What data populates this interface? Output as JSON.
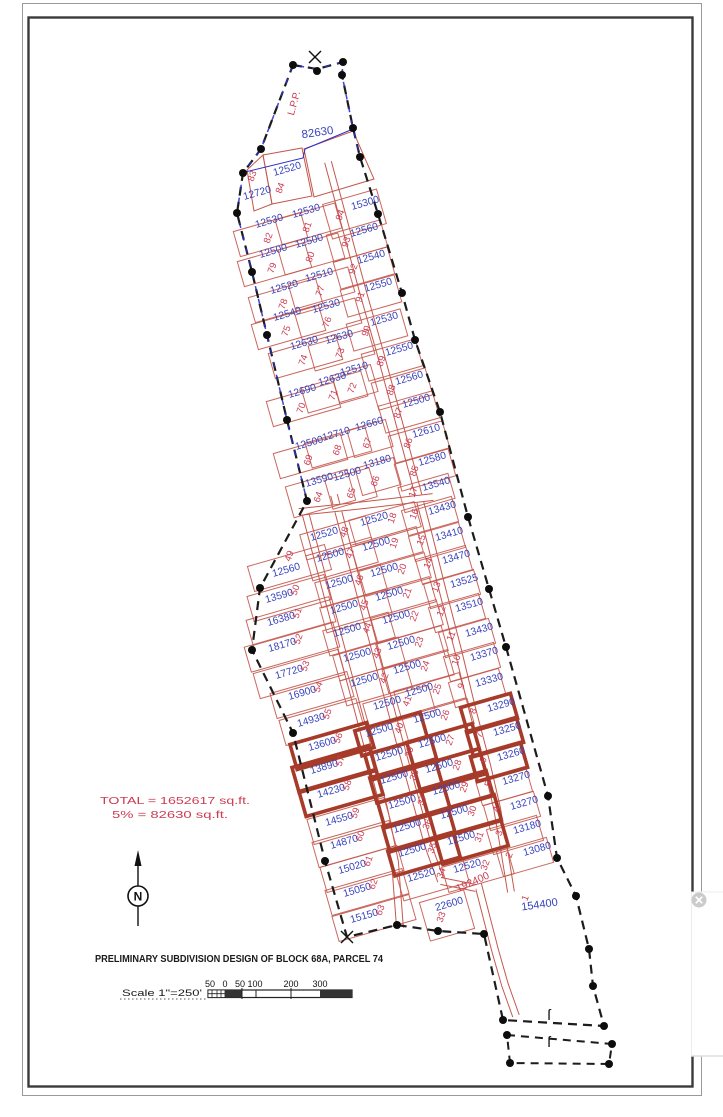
{
  "doc": {
    "title": "PRELIMINARY SUBDIVISION DESIGN OF BLOCK 68A, PARCEL 74",
    "scale_label": "Scale 1\"=250'",
    "scale_ticks": [
      "50",
      "0",
      "50",
      "100",
      "200",
      "300"
    ],
    "total_line1": "TOTAL = 1652617 sq.ft.",
    "total_line2": "5% = 82630 sq.ft.",
    "north_label": "N",
    "lpp_label": "L.P.P.",
    "lpp_area": "82630",
    "road_area": "192400"
  },
  "colors": {
    "lot_line": "#c4574d",
    "lot_thick": "#a63b2a",
    "area_text": "#3743bd",
    "lot_num": "#cc3b52",
    "boundary": "#1c1c1c",
    "blue_edge": "#2b2fc9",
    "annotation_red": "#cc3b52",
    "title_black": "#1a1a1a"
  },
  "plat": {
    "columns": {
      "wT": {
        "w": 0,
        "h": 20,
        "no": [
          -2,
          17
        ]
      },
      "wU": {
        "w": 70,
        "h": 26,
        "no": [
          1,
          15
        ]
      },
      "mU": {
        "w": 62,
        "h": 26,
        "no": [
          3,
          14
        ]
      },
      "m2": {
        "w": 40,
        "h": 28,
        "no": [
          0,
          17
        ]
      },
      "eU": {
        "w": 56,
        "h": 28,
        "no": [
          -16,
          10
        ]
      },
      "wL": {
        "w": 80,
        "h": 26,
        "no": [
          18,
          -8
        ]
      },
      "mwL": {
        "w": 68,
        "h": 26,
        "no": [
          22,
          -4
        ]
      },
      "meL": {
        "w": 68,
        "h": 26,
        "no": [
          20,
          -3
        ]
      },
      "eL": {
        "w": 52,
        "h": 26,
        "no": [
          -26,
          4
        ]
      }
    },
    "overrides": {
      "84": {
        "w": 0,
        "no": [
          -5,
          17
        ]
      },
      "83": {
        "w": 0,
        "no": [
          -3,
          -19
        ]
      },
      "94": {
        "h": 36,
        "no": [
          -23,
          10
        ]
      },
      "64": {
        "w": 64,
        "h": 32
      },
      "65": {
        "w": 46,
        "h": 30,
        "no": [
          6,
          17
        ]
      },
      "49": {
        "no": [
          5,
          -16
        ]
      },
      "51": {
        "w": 86
      },
      "52": {
        "w": 92
      },
      "53": {
        "w": 88
      },
      "54": {
        "w": 80
      },
      "17": {
        "no": [
          -21,
          6
        ]
      },
      "33": {
        "w": 46,
        "h": 40,
        "no": [
          -6,
          11
        ]
      },
      "1": {
        "w": 0,
        "no": [
          -12,
          -9
        ],
        "fs": 11,
        "rot": -8
      }
    },
    "lots": [
      [
        "84",
        "12520",
        288,
        172,
        "wT",
        0
      ],
      [
        "83",
        "12720",
        258,
        196,
        "wT",
        0
      ],
      [
        "94",
        "15300",
        366,
        206,
        "eU",
        0
      ],
      [
        "81",
        "12530",
        307,
        214,
        "mU",
        0
      ],
      [
        "82",
        "12530",
        270,
        224,
        "wU",
        0
      ],
      [
        "93",
        "12560",
        365,
        233,
        "eU",
        0
      ],
      [
        "80",
        "12500",
        310,
        244,
        "mU",
        0
      ],
      [
        "79",
        "12500",
        274,
        254,
        "wU",
        0
      ],
      [
        "92",
        "12540",
        372,
        260,
        "eU",
        0
      ],
      [
        "77",
        "12510",
        320,
        278,
        "mU",
        0
      ],
      [
        "78",
        "12520",
        285,
        290,
        "wU",
        0
      ],
      [
        "91",
        "12550",
        379,
        288,
        "eU",
        0
      ],
      [
        "76",
        "12530",
        327,
        309,
        "mU",
        0
      ],
      [
        "75",
        "12540",
        288,
        317,
        "wU",
        0
      ],
      [
        "90",
        "12530",
        385,
        322,
        "eU",
        0
      ],
      [
        "73",
        "12630",
        340,
        340,
        "mU",
        0
      ],
      [
        "74",
        "12630",
        305,
        346,
        "wU",
        0
      ],
      [
        "89",
        "12550",
        400,
        352,
        "eU",
        0
      ],
      [
        "72",
        "12510",
        355,
        372,
        "m2",
        0
      ],
      [
        "71",
        "12630",
        333,
        382,
        "mU",
        0
      ],
      [
        "88",
        "12560",
        410,
        381,
        "eU",
        0
      ],
      [
        "70",
        "12690",
        303,
        394,
        "wU",
        0
      ],
      [
        "87",
        "12500",
        417,
        404,
        "eU",
        0
      ],
      [
        "67",
        "12660",
        370,
        427,
        "m2",
        0
      ],
      [
        "68",
        "12710",
        337,
        437,
        "mU",
        0
      ],
      [
        "86",
        "12610",
        427,
        434,
        "eU",
        0
      ],
      [
        "69",
        "12500",
        310,
        446,
        "wU",
        0
      ],
      [
        "66",
        "13180",
        378,
        465,
        "m2",
        0
      ],
      [
        "85",
        "12580",
        433,
        462,
        "eU",
        0
      ],
      [
        "65",
        "12500",
        348,
        477,
        "mU",
        0
      ],
      [
        "17",
        "13540",
        437,
        487,
        "eL",
        0
      ],
      [
        "64",
        "13590",
        320,
        483,
        "wU",
        0
      ],
      [
        "16",
        "13430",
        443,
        511,
        "eL",
        0
      ],
      [
        "18",
        "12520",
        375,
        522,
        "meL",
        0
      ],
      [
        "48",
        "12520",
        325,
        537,
        "mwL",
        0
      ],
      [
        "15",
        "13410",
        450,
        537,
        "eL",
        0
      ],
      [
        "19",
        "12500",
        377,
        547,
        "meL",
        0
      ],
      [
        "47",
        "12500",
        331,
        558,
        "mwL",
        0
      ],
      [
        "14",
        "13470",
        457,
        560,
        "eL",
        0
      ],
      [
        "49",
        "12560",
        287,
        573,
        "wL",
        0
      ],
      [
        "20",
        "12500",
        385,
        573,
        "meL",
        0
      ],
      [
        "46",
        "12500",
        340,
        585,
        "mwL",
        0
      ],
      [
        "13",
        "13525",
        465,
        584,
        "eL",
        0
      ],
      [
        "50",
        "13590",
        280,
        599,
        "wL",
        0
      ],
      [
        "21",
        "12500",
        390,
        597,
        "meL",
        0
      ],
      [
        "45",
        "12500",
        345,
        610,
        "mwL",
        0
      ],
      [
        "12",
        "13510",
        470,
        608,
        "eL",
        0
      ],
      [
        "51",
        "16380",
        282,
        622,
        "wL",
        0
      ],
      [
        "22",
        "12500",
        397,
        620,
        "meL",
        0
      ],
      [
        "44",
        "12500",
        348,
        633,
        "mwL",
        0
      ],
      [
        "11",
        "13430",
        480,
        633,
        "eL",
        0
      ],
      [
        "52",
        "18170",
        283,
        648,
        "wL",
        0
      ],
      [
        "23",
        "12500",
        402,
        646,
        "meL",
        0
      ],
      [
        "43",
        "12500",
        358,
        658,
        "mwL",
        0
      ],
      [
        "10",
        "13370",
        485,
        657,
        "eL",
        0
      ],
      [
        "53",
        "17720",
        290,
        675,
        "wL",
        0
      ],
      [
        "24",
        "12500",
        408,
        670,
        "meL",
        0
      ],
      [
        "42",
        "12500",
        365,
        683,
        "mwL",
        0
      ],
      [
        "9",
        "13330",
        490,
        683,
        "eL",
        0
      ],
      [
        "54",
        "16900",
        303,
        696,
        "wL",
        0
      ],
      [
        "25",
        "12500",
        420,
        693,
        "meL",
        0
      ],
      [
        "41",
        "12500",
        388,
        706,
        "mwL",
        0
      ],
      [
        "8",
        "13290",
        502,
        708,
        "eL",
        1
      ],
      [
        "55",
        "14930",
        312,
        723,
        "wL",
        0
      ],
      [
        "26",
        "12500",
        428,
        719,
        "meL",
        0
      ],
      [
        "40",
        "12500",
        380,
        733,
        "mwL",
        1
      ],
      [
        "7",
        "13250",
        508,
        732,
        "eL",
        1
      ],
      [
        "56",
        "13600",
        323,
        747,
        "wL",
        1
      ],
      [
        "27",
        "12500",
        433,
        744,
        "meL",
        1
      ],
      [
        "39",
        "12500",
        390,
        757,
        "mwL",
        1
      ],
      [
        "6",
        "13260",
        512,
        757,
        "eL",
        1
      ],
      [
        "57",
        "13890",
        325,
        770,
        "wL",
        1
      ],
      [
        "28",
        "12500",
        440,
        769,
        "meL",
        1
      ],
      [
        "38",
        "12500",
        395,
        780,
        "mwL",
        1
      ],
      [
        "5",
        "13270",
        517,
        781,
        "eL",
        0
      ],
      [
        "58",
        "14230",
        332,
        794,
        "wL",
        1
      ],
      [
        "29",
        "12500",
        447,
        791,
        "meL",
        1
      ],
      [
        "37",
        "12500",
        403,
        805,
        "mwL",
        1
      ],
      [
        "30",
        "12500",
        455,
        815,
        "meL",
        1
      ],
      [
        "4",
        "13270",
        525,
        806,
        "eL",
        0
      ],
      [
        "59",
        "14550",
        340,
        822,
        "wL",
        0
      ],
      [
        "36",
        "12500",
        408,
        829,
        "mwL",
        1
      ],
      [
        "3",
        "13180",
        528,
        830,
        "eL",
        0
      ],
      [
        "31",
        "12500",
        462,
        841,
        "meL",
        1
      ],
      [
        "60",
        "14870",
        345,
        845,
        "wL",
        0
      ],
      [
        "35",
        "12500",
        413,
        853,
        "mwL",
        1
      ],
      [
        "2",
        "13080",
        538,
        852,
        "eL",
        0
      ],
      [
        "61",
        "15020",
        353,
        870,
        "wL",
        0
      ],
      [
        "32",
        "12520",
        468,
        869,
        "meL",
        0
      ],
      [
        "34",
        "12520",
        422,
        878,
        "mwL",
        0
      ],
      [
        "62",
        "15050",
        358,
        893,
        "wL",
        0
      ],
      [
        "1",
        "154400",
        540,
        908,
        "eL",
        0
      ],
      [
        "33",
        "22600",
        450,
        907,
        "meL",
        0
      ],
      [
        "63",
        "15150",
        365,
        919,
        "wL",
        0
      ]
    ],
    "boundary": [
      [
        293,
        65
      ],
      [
        317,
        69
      ],
      [
        343,
        62
      ],
      [
        342,
        75
      ],
      [
        353,
        128
      ],
      [
        360,
        157
      ],
      [
        378,
        214
      ],
      [
        402,
        293
      ],
      [
        415,
        340
      ],
      [
        440,
        412
      ],
      [
        468,
        517
      ],
      [
        489,
        589
      ],
      [
        506,
        647
      ],
      [
        548,
        796
      ],
      [
        557,
        858
      ],
      [
        576,
        896
      ],
      [
        589,
        949
      ],
      [
        593,
        986
      ],
      [
        604,
        1026
      ],
      [
        503,
        1020
      ],
      [
        484,
        934
      ],
      [
        438,
        931
      ],
      [
        397,
        925
      ],
      [
        347,
        937
      ],
      [
        325,
        861
      ],
      [
        293,
        733
      ],
      [
        252,
        650
      ],
      [
        260,
        588
      ],
      [
        307,
        501
      ],
      [
        287,
        420
      ],
      [
        267,
        335
      ],
      [
        252,
        272
      ],
      [
        237,
        213
      ],
      [
        243,
        173
      ],
      [
        261,
        149
      ],
      [
        293,
        65
      ]
    ],
    "blue_edge": [
      [
        360,
        157
      ],
      [
        353,
        128
      ],
      [
        342,
        75
      ],
      [
        343,
        62
      ],
      [
        317,
        69
      ],
      [
        293,
        65
      ],
      [
        261,
        149
      ],
      [
        243,
        173
      ],
      [
        237,
        213
      ],
      [
        252,
        272
      ],
      [
        267,
        335
      ],
      [
        287,
        420
      ],
      [
        307,
        501
      ]
    ],
    "parcel_b": [
      [
        507,
        1035
      ],
      [
        612,
        1044
      ],
      [
        609,
        1064
      ],
      [
        510,
        1063
      ],
      [
        507,
        1035
      ]
    ],
    "lpp_line": [
      [
        245,
        172
      ],
      [
        303,
        158
      ],
      [
        305,
        149
      ],
      [
        353,
        129
      ]
    ],
    "dots": [
      [
        293,
        65
      ],
      [
        317,
        71
      ],
      [
        343,
        62
      ],
      [
        342,
        75
      ],
      [
        353,
        128
      ],
      [
        360,
        157
      ],
      [
        378,
        214
      ],
      [
        402,
        293
      ],
      [
        415,
        340
      ],
      [
        440,
        412
      ],
      [
        468,
        517
      ],
      [
        489,
        589
      ],
      [
        506,
        647
      ],
      [
        548,
        796
      ],
      [
        557,
        858
      ],
      [
        576,
        896
      ],
      [
        589,
        949
      ],
      [
        593,
        986
      ],
      [
        604,
        1026
      ],
      [
        503,
        1020
      ],
      [
        484,
        934
      ],
      [
        438,
        931
      ],
      [
        397,
        925
      ],
      [
        325,
        861
      ],
      [
        293,
        733
      ],
      [
        252,
        650
      ],
      [
        260,
        588
      ],
      [
        307,
        501
      ],
      [
        287,
        420
      ],
      [
        267,
        335
      ],
      [
        252,
        272
      ],
      [
        237,
        213
      ],
      [
        243,
        173
      ],
      [
        261,
        149
      ],
      [
        507,
        1035
      ],
      [
        612,
        1044
      ],
      [
        609,
        1064
      ],
      [
        510,
        1063
      ]
    ],
    "xmarks": [
      [
        315,
        57
      ],
      [
        347,
        937
      ]
    ],
    "smarks": [
      [
        549,
        1020
      ],
      [
        549,
        1047
      ]
    ],
    "roads": [
      [
        [
          328,
          162
        ],
        [
          345,
          225
        ],
        [
          363,
          292
        ],
        [
          380,
          352
        ],
        [
          397,
          415
        ],
        [
          414,
          478
        ],
        [
          428,
          532
        ],
        [
          443,
          592
        ],
        [
          458,
          650
        ],
        [
          472,
          708
        ],
        [
          487,
          765
        ],
        [
          497,
          808
        ],
        [
          505,
          855
        ],
        [
          511,
          892
        ]
      ],
      [
        [
          334,
          495
        ],
        [
          350,
          556
        ],
        [
          366,
          616
        ],
        [
          382,
          676
        ],
        [
          398,
          736
        ],
        [
          414,
          794
        ],
        [
          428,
          845
        ],
        [
          441,
          881
        ]
      ],
      [
        [
          304,
          508
        ],
        [
          320,
          568
        ],
        [
          336,
          628
        ],
        [
          352,
          688
        ],
        [
          368,
          748
        ],
        [
          384,
          808
        ],
        [
          395,
          862
        ],
        [
          400,
          928
        ]
      ],
      [
        [
          478,
          884
        ],
        [
          495,
          950
        ],
        [
          505,
          985
        ],
        [
          516,
          1016
        ]
      ],
      [
        [
          299,
          512
        ],
        [
          365,
          505
        ],
        [
          433,
          497
        ]
      ],
      [
        [
          441,
          881
        ],
        [
          476,
          888
        ]
      ]
    ],
    "quads": [
      [
        [
          263,
          155
        ],
        [
          302,
          148
        ],
        [
          312,
          196
        ],
        [
          272,
          204
        ]
      ],
      [
        [
          247,
          170
        ],
        [
          263,
          155
        ],
        [
          272,
          204
        ],
        [
          254,
          211
        ]
      ],
      [
        [
          304,
          149
        ],
        [
          353,
          131
        ],
        [
          374,
          179
        ],
        [
          314,
          197
        ]
      ]
    ]
  }
}
